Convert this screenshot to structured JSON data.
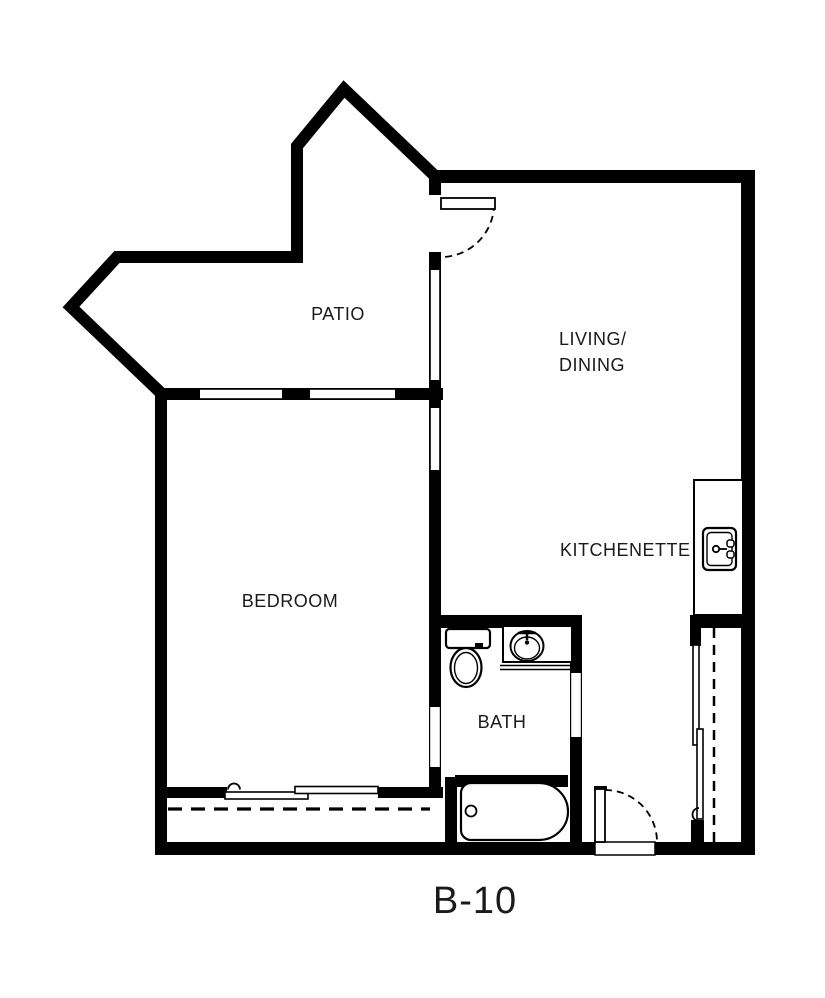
{
  "floor_plan": {
    "unit_label": "B-10",
    "rooms": {
      "patio": {
        "label": "PATIO"
      },
      "living_dining": {
        "line1": "LIVING/",
        "line2": "DINING"
      },
      "kitchenette": {
        "label": "KITCHENETTE"
      },
      "bedroom": {
        "label": "BEDROOM"
      },
      "bath": {
        "label": "BATH"
      }
    },
    "fixtures": {
      "kitchen_sink": "kitchen-sink-icon",
      "bath_sink": "bathroom-sink-icon",
      "toilet": "toilet-icon",
      "bathtub": "bathtub-icon",
      "closet_rod": "closet-rod-dashed-line",
      "closet_doors": "sliding-closet-doors",
      "entry_door": "entry-door-with-swing-arc",
      "patio_door": "patio-door-with-swing-arc",
      "bedroom_window": "sliding-window"
    },
    "colors": {
      "walls": "#000000",
      "background": "#ffffff",
      "text": "#1a1a1a"
    }
  }
}
